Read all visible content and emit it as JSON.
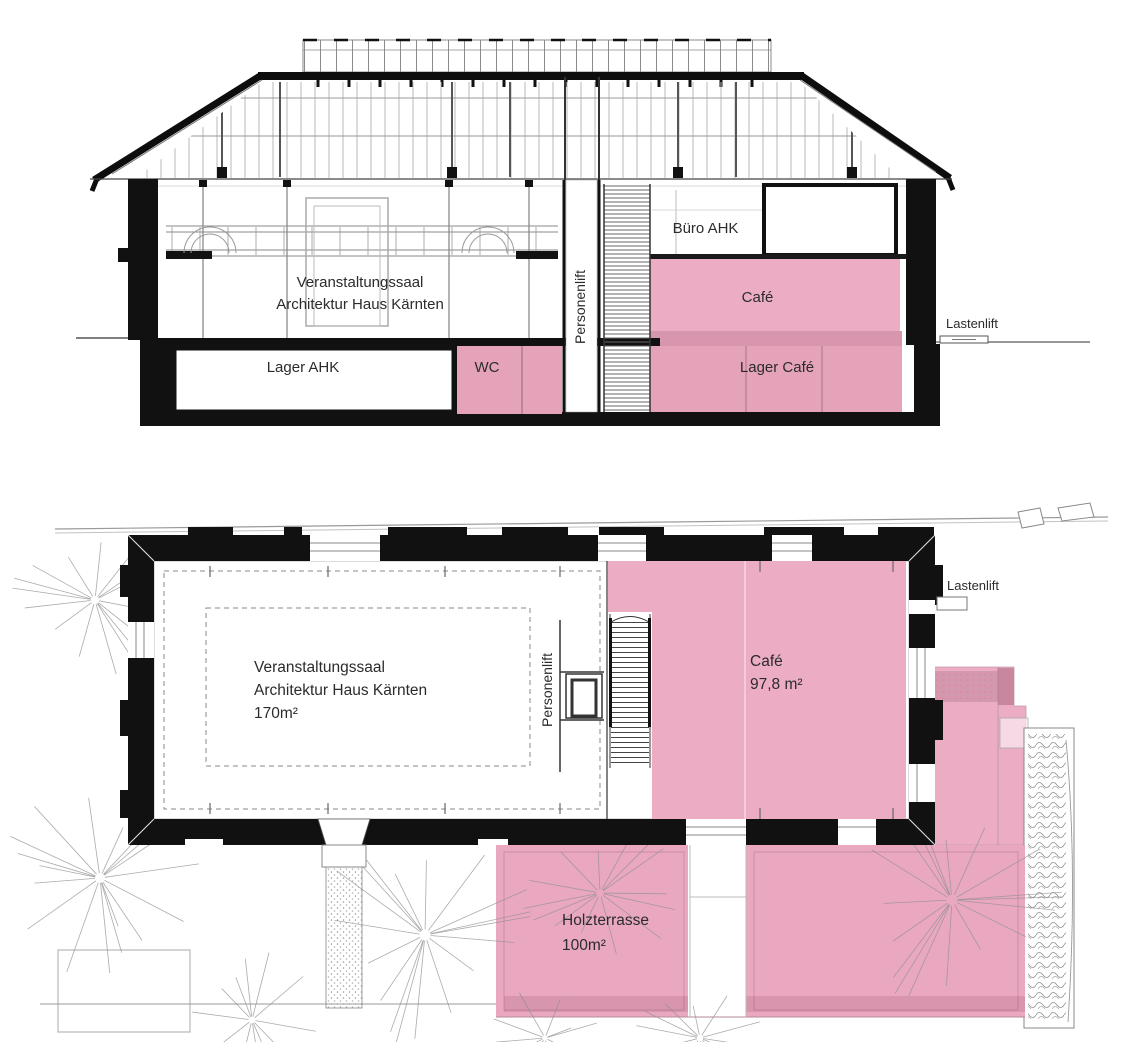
{
  "drawing_title": "Architektur Haus Kärnten – Schnitt und Grundriss",
  "colors": {
    "highlight_pink": "#ecacc3",
    "highlight_pink_muted": "#e4a3b9",
    "highlight_pink_dark": "#d795ae",
    "highlight_pink_deep": "#c9879f",
    "ink": "#111111",
    "line_gray": "#999999"
  },
  "section": {
    "labels": {
      "hall_line1": "Veranstaltungssaal",
      "hall_line2": "Architektur Haus Kärnten",
      "buero": "Büro AHK",
      "cafe": "Café",
      "personenlift": "Personenlift",
      "lastenlift": "Lastenlift",
      "lager_ahk": "Lager AHK",
      "wc": "WC",
      "lager_cafe": "Lager Café"
    }
  },
  "plan": {
    "labels": {
      "hall_line1": "Veranstaltungssaal",
      "hall_line2": "Architektur Haus Kärnten",
      "hall_area": "170m²",
      "personenlift": "Personenlift",
      "cafe": "Café",
      "cafe_area": "97,8 m²",
      "lastenlift": "Lastenlift",
      "terrace_line1": "Holzterrasse",
      "terrace_line2": "100m²"
    },
    "trees": [
      {
        "cx": 95,
        "cy": 600,
        "r": 85,
        "n": 16
      },
      {
        "cx": 100,
        "cy": 878,
        "r": 100,
        "n": 18
      },
      {
        "cx": 425,
        "cy": 935,
        "r": 112,
        "n": 18
      },
      {
        "cx": 600,
        "cy": 893,
        "r": 78,
        "n": 14
      },
      {
        "cx": 952,
        "cy": 900,
        "r": 110,
        "n": 18
      },
      {
        "cx": 252,
        "cy": 1020,
        "r": 70,
        "n": 12
      },
      {
        "cx": 700,
        "cy": 1038,
        "r": 65,
        "n": 12
      },
      {
        "cx": 545,
        "cy": 1038,
        "r": 55,
        "n": 10
      }
    ]
  }
}
